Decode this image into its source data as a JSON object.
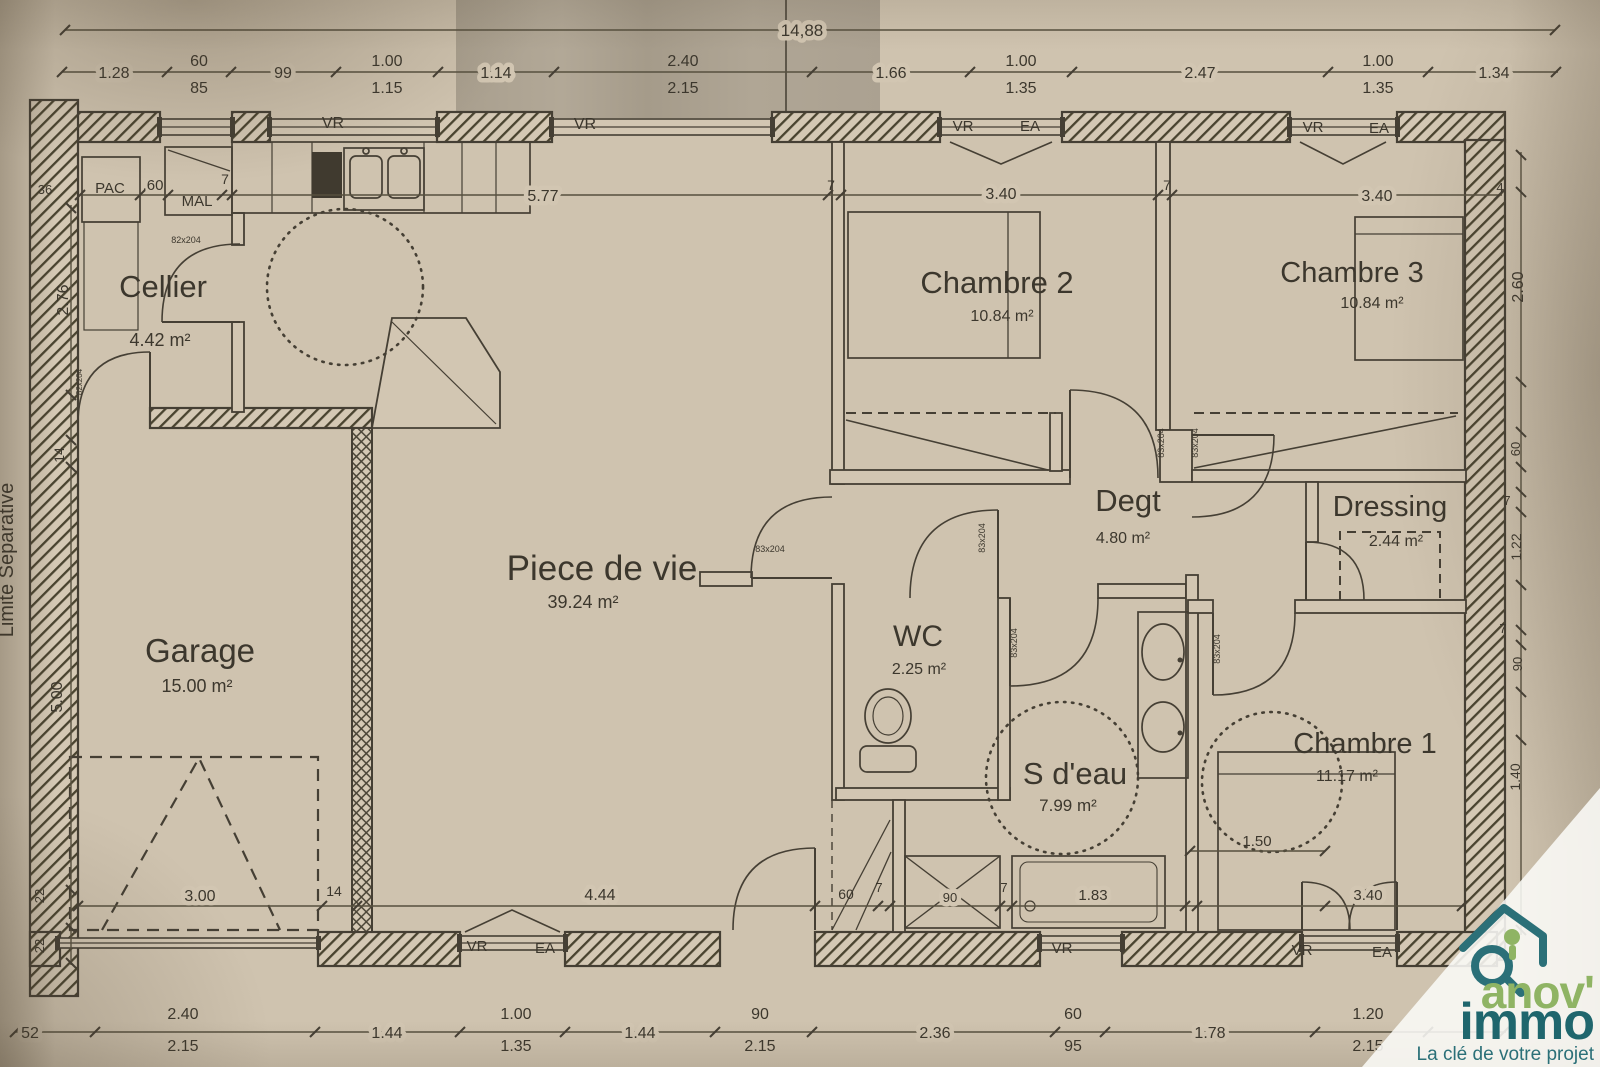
{
  "logo": {
    "brand_line1": "anov'",
    "brand_line2": "immo",
    "tagline": "La clé de votre projet",
    "green": "#8fb464",
    "teal": "#1f666d",
    "tagline_color": "#2b7078"
  },
  "plan": {
    "ink_color": "#453f34",
    "paper_color": "#cfc3af",
    "boundary_label": {
      "id": "limite-separative",
      "text": "Limite Separative",
      "x": 13,
      "y": 560,
      "s": 20,
      "rot": 1
    },
    "room_labels": [
      {
        "id": "cellier-name",
        "text": "Cellier",
        "x": 163,
        "y": 297,
        "s": 31
      },
      {
        "id": "cellier-area",
        "text": "4.42 m²",
        "x": 160,
        "y": 346,
        "s": 18
      },
      {
        "id": "garage-name",
        "text": "Garage",
        "x": 200,
        "y": 662,
        "s": 33
      },
      {
        "id": "garage-area",
        "text": "15.00 m²",
        "x": 197,
        "y": 692,
        "s": 18
      },
      {
        "id": "piece-de-vie-name",
        "text": "Piece de vie",
        "x": 602,
        "y": 580,
        "s": 35
      },
      {
        "id": "piece-de-vie-area",
        "text": "39.24 m²",
        "x": 583,
        "y": 608,
        "s": 18
      },
      {
        "id": "wc-name",
        "text": "WC",
        "x": 918,
        "y": 646,
        "s": 30
      },
      {
        "id": "wc-area",
        "text": "2.25 m²",
        "x": 919,
        "y": 674,
        "s": 16
      },
      {
        "id": "s-deau-name",
        "text": "S d'eau",
        "x": 1075,
        "y": 784,
        "s": 31
      },
      {
        "id": "s-deau-area",
        "text": "7.99 m²",
        "x": 1068,
        "y": 811,
        "s": 17
      },
      {
        "id": "degt-name",
        "text": "Degt",
        "x": 1128,
        "y": 511,
        "s": 31
      },
      {
        "id": "degt-area",
        "text": "4.80 m²",
        "x": 1123,
        "y": 543,
        "s": 16
      },
      {
        "id": "dressing-name",
        "text": "Dressing",
        "x": 1390,
        "y": 516,
        "s": 29
      },
      {
        "id": "dressing-area",
        "text": "2.44 m²",
        "x": 1396,
        "y": 546,
        "s": 16
      },
      {
        "id": "chambre1-name",
        "text": "Chambre 1",
        "x": 1365,
        "y": 753,
        "s": 29
      },
      {
        "id": "chambre1-area",
        "text": "11.17 m²",
        "x": 1347,
        "y": 781,
        "s": 16
      },
      {
        "id": "chambre2-name",
        "text": "Chambre 2",
        "x": 997,
        "y": 293,
        "s": 31
      },
      {
        "id": "chambre2-area",
        "text": "10.84 m²",
        "x": 1002,
        "y": 321,
        "s": 16
      },
      {
        "id": "chambre3-name",
        "text": "Chambre 3",
        "x": 1352,
        "y": 282,
        "s": 29
      },
      {
        "id": "chambre3-area",
        "text": "10.84 m²",
        "x": 1372,
        "y": 308,
        "s": 16
      }
    ],
    "equipment_labels": [
      {
        "id": "pac",
        "text": "PAC",
        "x": 110,
        "y": 193,
        "s": 15
      },
      {
        "id": "mal",
        "text": "MAL",
        "x": 197,
        "y": 206,
        "s": 15
      }
    ],
    "window_labels": [
      {
        "id": "vr-top-1",
        "text": "VR",
        "x": 333,
        "y": 128,
        "s": 16
      },
      {
        "id": "vr-top-2",
        "text": "VR",
        "x": 585,
        "y": 129,
        "s": 16
      },
      {
        "id": "vr-top-3",
        "text": "VR",
        "x": 963,
        "y": 131,
        "s": 15
      },
      {
        "id": "ea-top-1",
        "text": "EA",
        "x": 1030,
        "y": 131,
        "s": 15
      },
      {
        "id": "vr-top-4",
        "text": "VR",
        "x": 1313,
        "y": 132,
        "s": 15
      },
      {
        "id": "ea-top-2",
        "text": "EA",
        "x": 1379,
        "y": 133,
        "s": 15
      },
      {
        "id": "vr-bottom-1",
        "text": "VR",
        "x": 477,
        "y": 951,
        "s": 15
      },
      {
        "id": "ea-bottom-1",
        "text": "EA",
        "x": 545,
        "y": 953,
        "s": 15
      },
      {
        "id": "vr-bottom-2",
        "text": "VR",
        "x": 1062,
        "y": 953,
        "s": 15
      },
      {
        "id": "vr-bottom-3",
        "text": "VR",
        "x": 1302,
        "y": 955,
        "s": 15
      },
      {
        "id": "ea-bottom-2",
        "text": "EA",
        "x": 1382,
        "y": 957,
        "s": 15
      }
    ],
    "door_labels": [
      {
        "id": "door-83x204-wc-corridor",
        "text": "83x204",
        "x": 770,
        "y": 552,
        "s": 9
      },
      {
        "id": "door-83x204-wc",
        "text": "83x204",
        "x": 985,
        "y": 538,
        "s": 9,
        "rot": 1
      },
      {
        "id": "door-83x204-sdeau",
        "text": "83x204",
        "x": 1017,
        "y": 643,
        "s": 9,
        "rot": 1
      },
      {
        "id": "door-83x204-ch1",
        "text": "83x204",
        "x": 1220,
        "y": 649,
        "s": 9,
        "rot": 1
      },
      {
        "id": "door-83x204-ch2",
        "text": "83x204",
        "x": 1164,
        "y": 443,
        "s": 9,
        "rot": 1
      },
      {
        "id": "door-83x204-ch3",
        "text": "83x204",
        "x": 1198,
        "y": 443,
        "s": 9,
        "rot": 1
      },
      {
        "id": "door-82x204-cellier",
        "text": "82x204",
        "x": 186,
        "y": 243,
        "s": 9
      },
      {
        "id": "door-82x204-garage",
        "text": "82x204",
        "x": 82,
        "y": 382,
        "s": 8,
        "rot": 1
      }
    ],
    "dimensions_top": [
      {
        "id": "dim-overall",
        "text": "14,88",
        "x": 802,
        "y": 36,
        "s": 17,
        "ko": 1
      },
      {
        "id": "dim-t1",
        "text": "1.28",
        "x": 114,
        "y": 78,
        "s": 16,
        "ko": 1
      },
      {
        "id": "dim-t2a",
        "text": "60",
        "x": 199,
        "y": 66,
        "s": 16
      },
      {
        "id": "dim-t2b",
        "text": "85",
        "x": 199,
        "y": 93,
        "s": 16
      },
      {
        "id": "dim-t3",
        "text": "99",
        "x": 283,
        "y": 78,
        "s": 16,
        "ko": 1
      },
      {
        "id": "dim-t4a",
        "text": "1.00",
        "x": 387,
        "y": 66,
        "s": 16
      },
      {
        "id": "dim-t4b",
        "text": "1.15",
        "x": 387,
        "y": 93,
        "s": 16
      },
      {
        "id": "dim-t5",
        "text": "1.14",
        "x": 496,
        "y": 78,
        "s": 16,
        "ko": 1
      },
      {
        "id": "dim-t6a",
        "text": "2.40",
        "x": 683,
        "y": 66,
        "s": 16
      },
      {
        "id": "dim-t6b",
        "text": "2.15",
        "x": 683,
        "y": 93,
        "s": 16
      },
      {
        "id": "dim-t7",
        "text": "1.66",
        "x": 891,
        "y": 78,
        "s": 16,
        "ko": 1
      },
      {
        "id": "dim-t8a",
        "text": "1.00",
        "x": 1021,
        "y": 66,
        "s": 16
      },
      {
        "id": "dim-t8b",
        "text": "1.35",
        "x": 1021,
        "y": 93,
        "s": 16
      },
      {
        "id": "dim-t9",
        "text": "2.47",
        "x": 1200,
        "y": 78,
        "s": 16,
        "ko": 1
      },
      {
        "id": "dim-t10a",
        "text": "1.00",
        "x": 1378,
        "y": 66,
        "s": 16
      },
      {
        "id": "dim-t10b",
        "text": "1.35",
        "x": 1378,
        "y": 93,
        "s": 16
      },
      {
        "id": "dim-t11",
        "text": "1.34",
        "x": 1494,
        "y": 78,
        "s": 16,
        "ko": 1
      }
    ],
    "dimensions_interior": [
      {
        "id": "dim-i1",
        "text": ".60",
        "x": 153,
        "y": 190,
        "s": 15
      },
      {
        "id": "dim-i2",
        "text": "7",
        "x": 225,
        "y": 184,
        "s": 14
      },
      {
        "id": "dim-i3",
        "text": "5.77",
        "x": 543,
        "y": 201,
        "s": 16,
        "ko": 1
      },
      {
        "id": "dim-i4",
        "text": "7",
        "x": 831,
        "y": 190,
        "s": 14
      },
      {
        "id": "dim-i5",
        "text": "3.40",
        "x": 1001,
        "y": 199,
        "s": 16,
        "ko": 1
      },
      {
        "id": "dim-i6",
        "text": "7",
        "x": 1167,
        "y": 190,
        "s": 14
      },
      {
        "id": "dim-i7",
        "text": "3.40",
        "x": 1377,
        "y": 201,
        "s": 16,
        "ko": 1
      },
      {
        "id": "dim-i8",
        "text": "4",
        "x": 1500,
        "y": 192,
        "s": 13
      },
      {
        "id": "dim-i9",
        "text": "3.00",
        "x": 200,
        "y": 901,
        "s": 16,
        "ko": 1
      },
      {
        "id": "dim-i10",
        "text": "14",
        "x": 334,
        "y": 896,
        "s": 14
      },
      {
        "id": "dim-i11",
        "text": "4.44",
        "x": 600,
        "y": 900,
        "s": 16,
        "ko": 1
      },
      {
        "id": "dim-i12",
        "text": "60",
        "x": 846,
        "y": 899,
        "s": 14
      },
      {
        "id": "dim-i13",
        "text": "7",
        "x": 879,
        "y": 892,
        "s": 13
      },
      {
        "id": "dim-i14",
        "text": "90",
        "x": 950,
        "y": 902,
        "s": 13,
        "ko": 1
      },
      {
        "id": "dim-i15",
        "text": "7",
        "x": 1004,
        "y": 892,
        "s": 13
      },
      {
        "id": "dim-i16",
        "text": "1.83",
        "x": 1093,
        "y": 900,
        "s": 15,
        "ko": 1
      },
      {
        "id": "dim-i17",
        "text": "3.40",
        "x": 1368,
        "y": 900,
        "s": 15,
        "ko": 1
      },
      {
        "id": "dim-i18",
        "text": "1.50",
        "x": 1257,
        "y": 846,
        "s": 15
      }
    ],
    "dimensions_left": [
      {
        "id": "dim-l1",
        "text": "36",
        "x": 45,
        "y": 194,
        "s": 13
      },
      {
        "id": "dim-l2",
        "text": "2.76",
        "x": 68,
        "y": 300,
        "s": 16,
        "rot": 1
      },
      {
        "id": "dim-l3",
        "text": "14",
        "x": 64,
        "y": 455,
        "s": 14,
        "rot": 1
      },
      {
        "id": "dim-l4",
        "text": "5.00",
        "x": 62,
        "y": 697,
        "s": 16,
        "rot": 1
      },
      {
        "id": "dim-l5",
        "text": "22",
        "x": 44,
        "y": 896,
        "s": 13,
        "rot": 1
      },
      {
        "id": "dim-l6",
        "text": "22",
        "x": 44,
        "y": 946,
        "s": 13,
        "rot": 1
      }
    ],
    "dimensions_right": [
      {
        "id": "dim-r1",
        "text": "2.60",
        "x": 1523,
        "y": 287,
        "s": 16,
        "rot": 1
      },
      {
        "id": "dim-r2",
        "text": "60",
        "x": 1520,
        "y": 449,
        "s": 13,
        "rot": 1
      },
      {
        "id": "dim-r3",
        "text": "7",
        "x": 1507,
        "y": 505,
        "s": 13
      },
      {
        "id": "dim-r4",
        "text": "1.22",
        "x": 1521,
        "y": 547,
        "s": 14,
        "rot": 1
      },
      {
        "id": "dim-r5",
        "text": "7",
        "x": 1503,
        "y": 633,
        "s": 13
      },
      {
        "id": "dim-r6",
        "text": "90",
        "x": 1522,
        "y": 664,
        "s": 13,
        "rot": 1
      },
      {
        "id": "dim-r7",
        "text": "1.40",
        "x": 1520,
        "y": 777,
        "s": 14,
        "rot": 1
      }
    ],
    "dimensions_bottom": [
      {
        "id": "dim-b1",
        "text": "52",
        "x": 30,
        "y": 1038,
        "s": 16,
        "ko": 1
      },
      {
        "id": "dim-b2a",
        "text": "2.40",
        "x": 183,
        "y": 1019,
        "s": 16
      },
      {
        "id": "dim-b2b",
        "text": "2.15",
        "x": 183,
        "y": 1051,
        "s": 16
      },
      {
        "id": "dim-b3",
        "text": "1.44",
        "x": 387,
        "y": 1038,
        "s": 16,
        "ko": 1
      },
      {
        "id": "dim-b4a",
        "text": "1.00",
        "x": 516,
        "y": 1019,
        "s": 16
      },
      {
        "id": "dim-b4b",
        "text": "1.35",
        "x": 516,
        "y": 1051,
        "s": 16
      },
      {
        "id": "dim-b5",
        "text": "1.44",
        "x": 640,
        "y": 1038,
        "s": 16,
        "ko": 1
      },
      {
        "id": "dim-b6a",
        "text": "90",
        "x": 760,
        "y": 1019,
        "s": 16
      },
      {
        "id": "dim-b6b",
        "text": "2.15",
        "x": 760,
        "y": 1051,
        "s": 16
      },
      {
        "id": "dim-b7",
        "text": "2.36",
        "x": 935,
        "y": 1038,
        "s": 16,
        "ko": 1
      },
      {
        "id": "dim-b8a",
        "text": "60",
        "x": 1073,
        "y": 1019,
        "s": 16
      },
      {
        "id": "dim-b8b",
        "text": "95",
        "x": 1073,
        "y": 1051,
        "s": 16
      },
      {
        "id": "dim-b9",
        "text": "1.78",
        "x": 1210,
        "y": 1038,
        "s": 16,
        "ko": 1
      },
      {
        "id": "dim-b10a",
        "text": "1.20",
        "x": 1368,
        "y": 1019,
        "s": 16
      },
      {
        "id": "dim-b10b",
        "text": "2.15",
        "x": 1368,
        "y": 1051,
        "s": 16
      }
    ]
  }
}
